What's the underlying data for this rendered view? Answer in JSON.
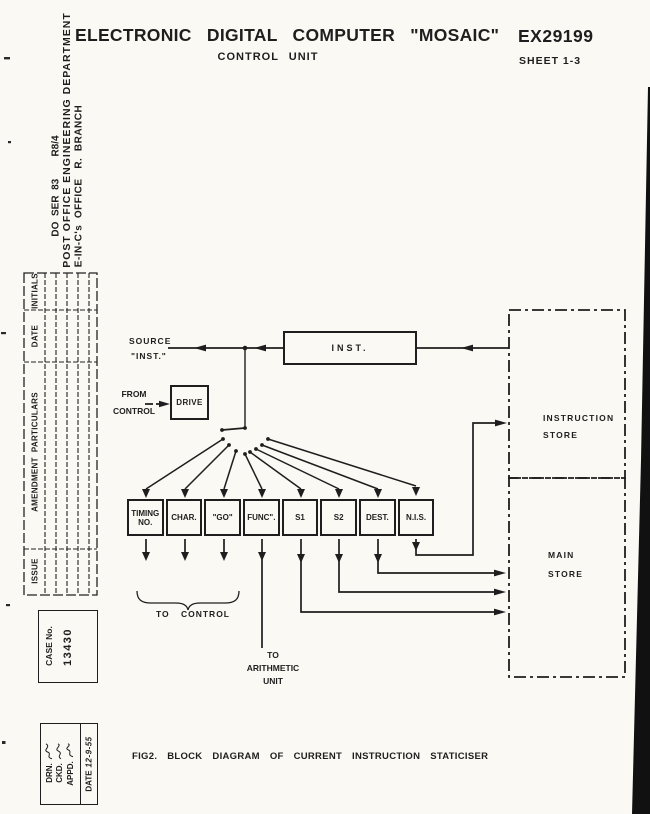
{
  "header": {
    "title": "ELECTRONIC DIGITAL COMPUTER \"MOSAIC\"",
    "subtitle": "CONTROL UNIT",
    "drawing_number": "EX29199",
    "sheet": "SHEET 1-3"
  },
  "side_margin": {
    "series_ref": "DO  SER  83        R8/4",
    "department": "POST OFFICE ENGINEERING DEPARTMENT",
    "office": "E-IN-C's  OFFICE   R.  BRANCH"
  },
  "amendment_table": {
    "col_issue": "ISSUE",
    "col_particulars": "AMENDMENT  PARTICULARS",
    "col_date": "DATE",
    "col_initials": "INITIALS"
  },
  "case_box": {
    "label": "CASE No.",
    "number": "13430"
  },
  "approval_box": {
    "drn_label": "DRN.",
    "ckd_label": "CKD.",
    "appd_label": "APPD.",
    "date_label": "DATE",
    "date_value": "12-9-55"
  },
  "diagram": {
    "source_line1": "SOURCE",
    "source_line2": "\"INST.\"",
    "from_line1": "FROM",
    "from_line2": "CONTROL",
    "drive_box_label": "DRIVE",
    "inst_box_label": "INST.",
    "registers": [
      "TIMING NO.",
      "CHAR.",
      "\"GO\"",
      "FUNC\".",
      "S1",
      "S2",
      "DEST.",
      "N.I.S."
    ],
    "to_control_label": "TO CONTROL",
    "to_arithmetic_line1": "TO",
    "to_arithmetic_line2": "ARITHMETIC",
    "to_arithmetic_line3": "UNIT",
    "instruction_store_line1": "INSTRUCTION",
    "instruction_store_line2": "STORE",
    "main_store_line1": "MAIN",
    "main_store_line2": "STORE"
  },
  "caption": "FIG2. BLOCK DIAGRAM OF CURRENT INSTRUCTION STATICISER",
  "colors": {
    "ink": "#1e1e1e",
    "paper": "#faf9f4"
  }
}
